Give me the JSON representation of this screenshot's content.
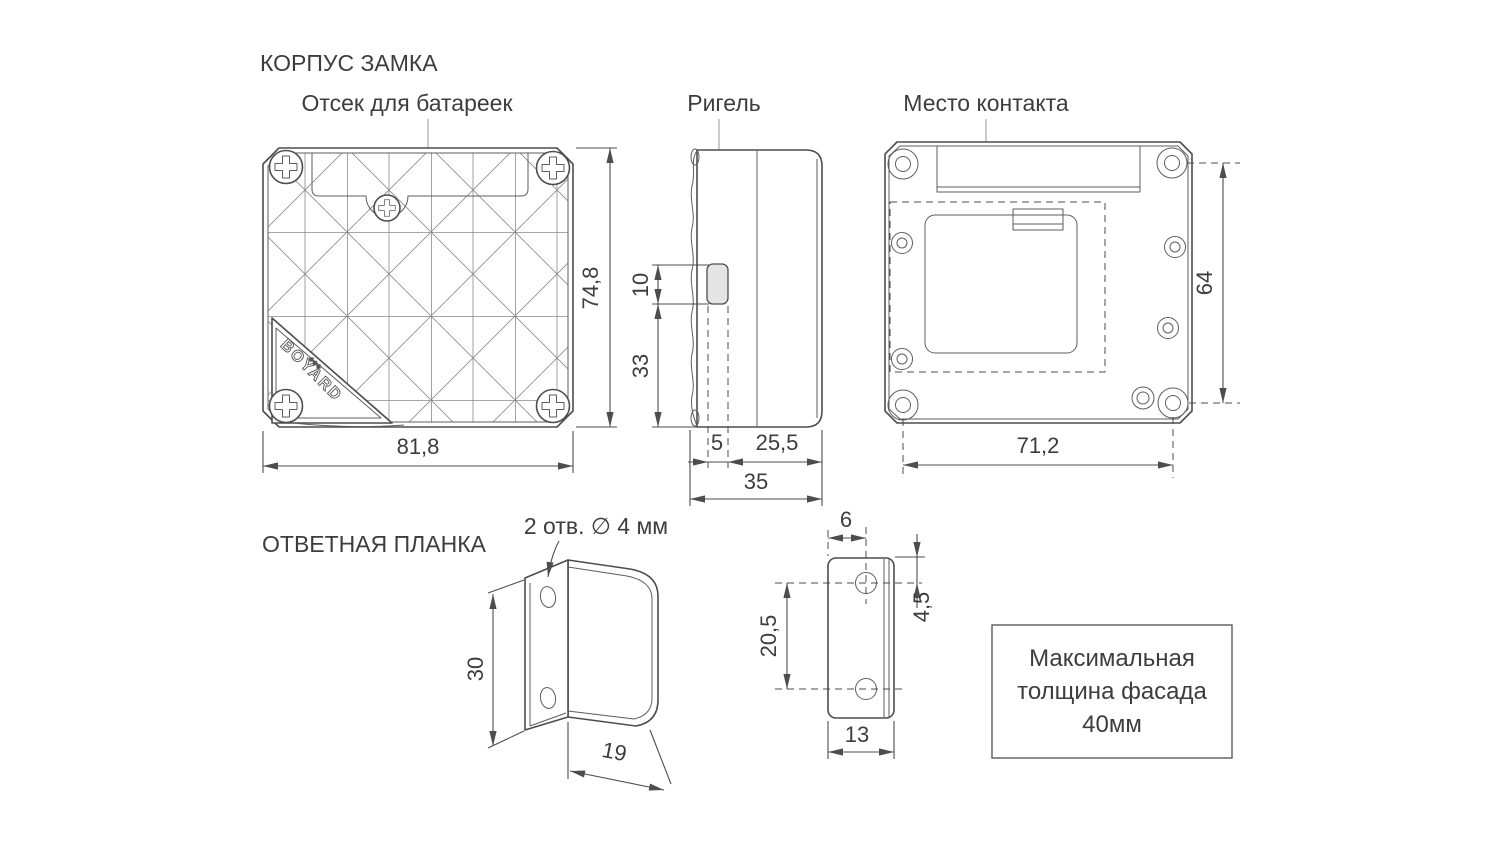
{
  "page": {
    "background": "#ffffff",
    "line_color": "#4d4d4d",
    "text_color": "#3d3d3d",
    "bolt_fill": "#e4e4e4"
  },
  "sections": {
    "lock_body_title": "КОРПУС ЗАМКА",
    "strike_plate_title": "ОТВЕТНАЯ ПЛАНКА"
  },
  "labels": {
    "battery_compartment": "Отсек для батареек",
    "bolt": "Ригель",
    "contact_area": "Место контакта",
    "holes_note": "2 отв. ∅ 4 мм",
    "brand": "BOYARD"
  },
  "dimensions": {
    "front_width": "81,8",
    "front_height": "74,8",
    "bolt_height": "10",
    "bolt_to_bottom": "33",
    "bolt_protrusion": "5",
    "case_front_depth": "25,5",
    "case_total_depth": "35",
    "back_hole_spacing_h": "71,2",
    "back_hole_spacing_v": "64",
    "plate_height": "30",
    "plate_flange_depth": "19",
    "plate_hole_edge_offset": "6",
    "plate_hole_top_offset": "4,5",
    "plate_hole_spacing": "20,5",
    "plate_width": "13"
  },
  "note_box": {
    "lines": [
      "Максимальная",
      "толщина фасада",
      "40мм"
    ]
  }
}
